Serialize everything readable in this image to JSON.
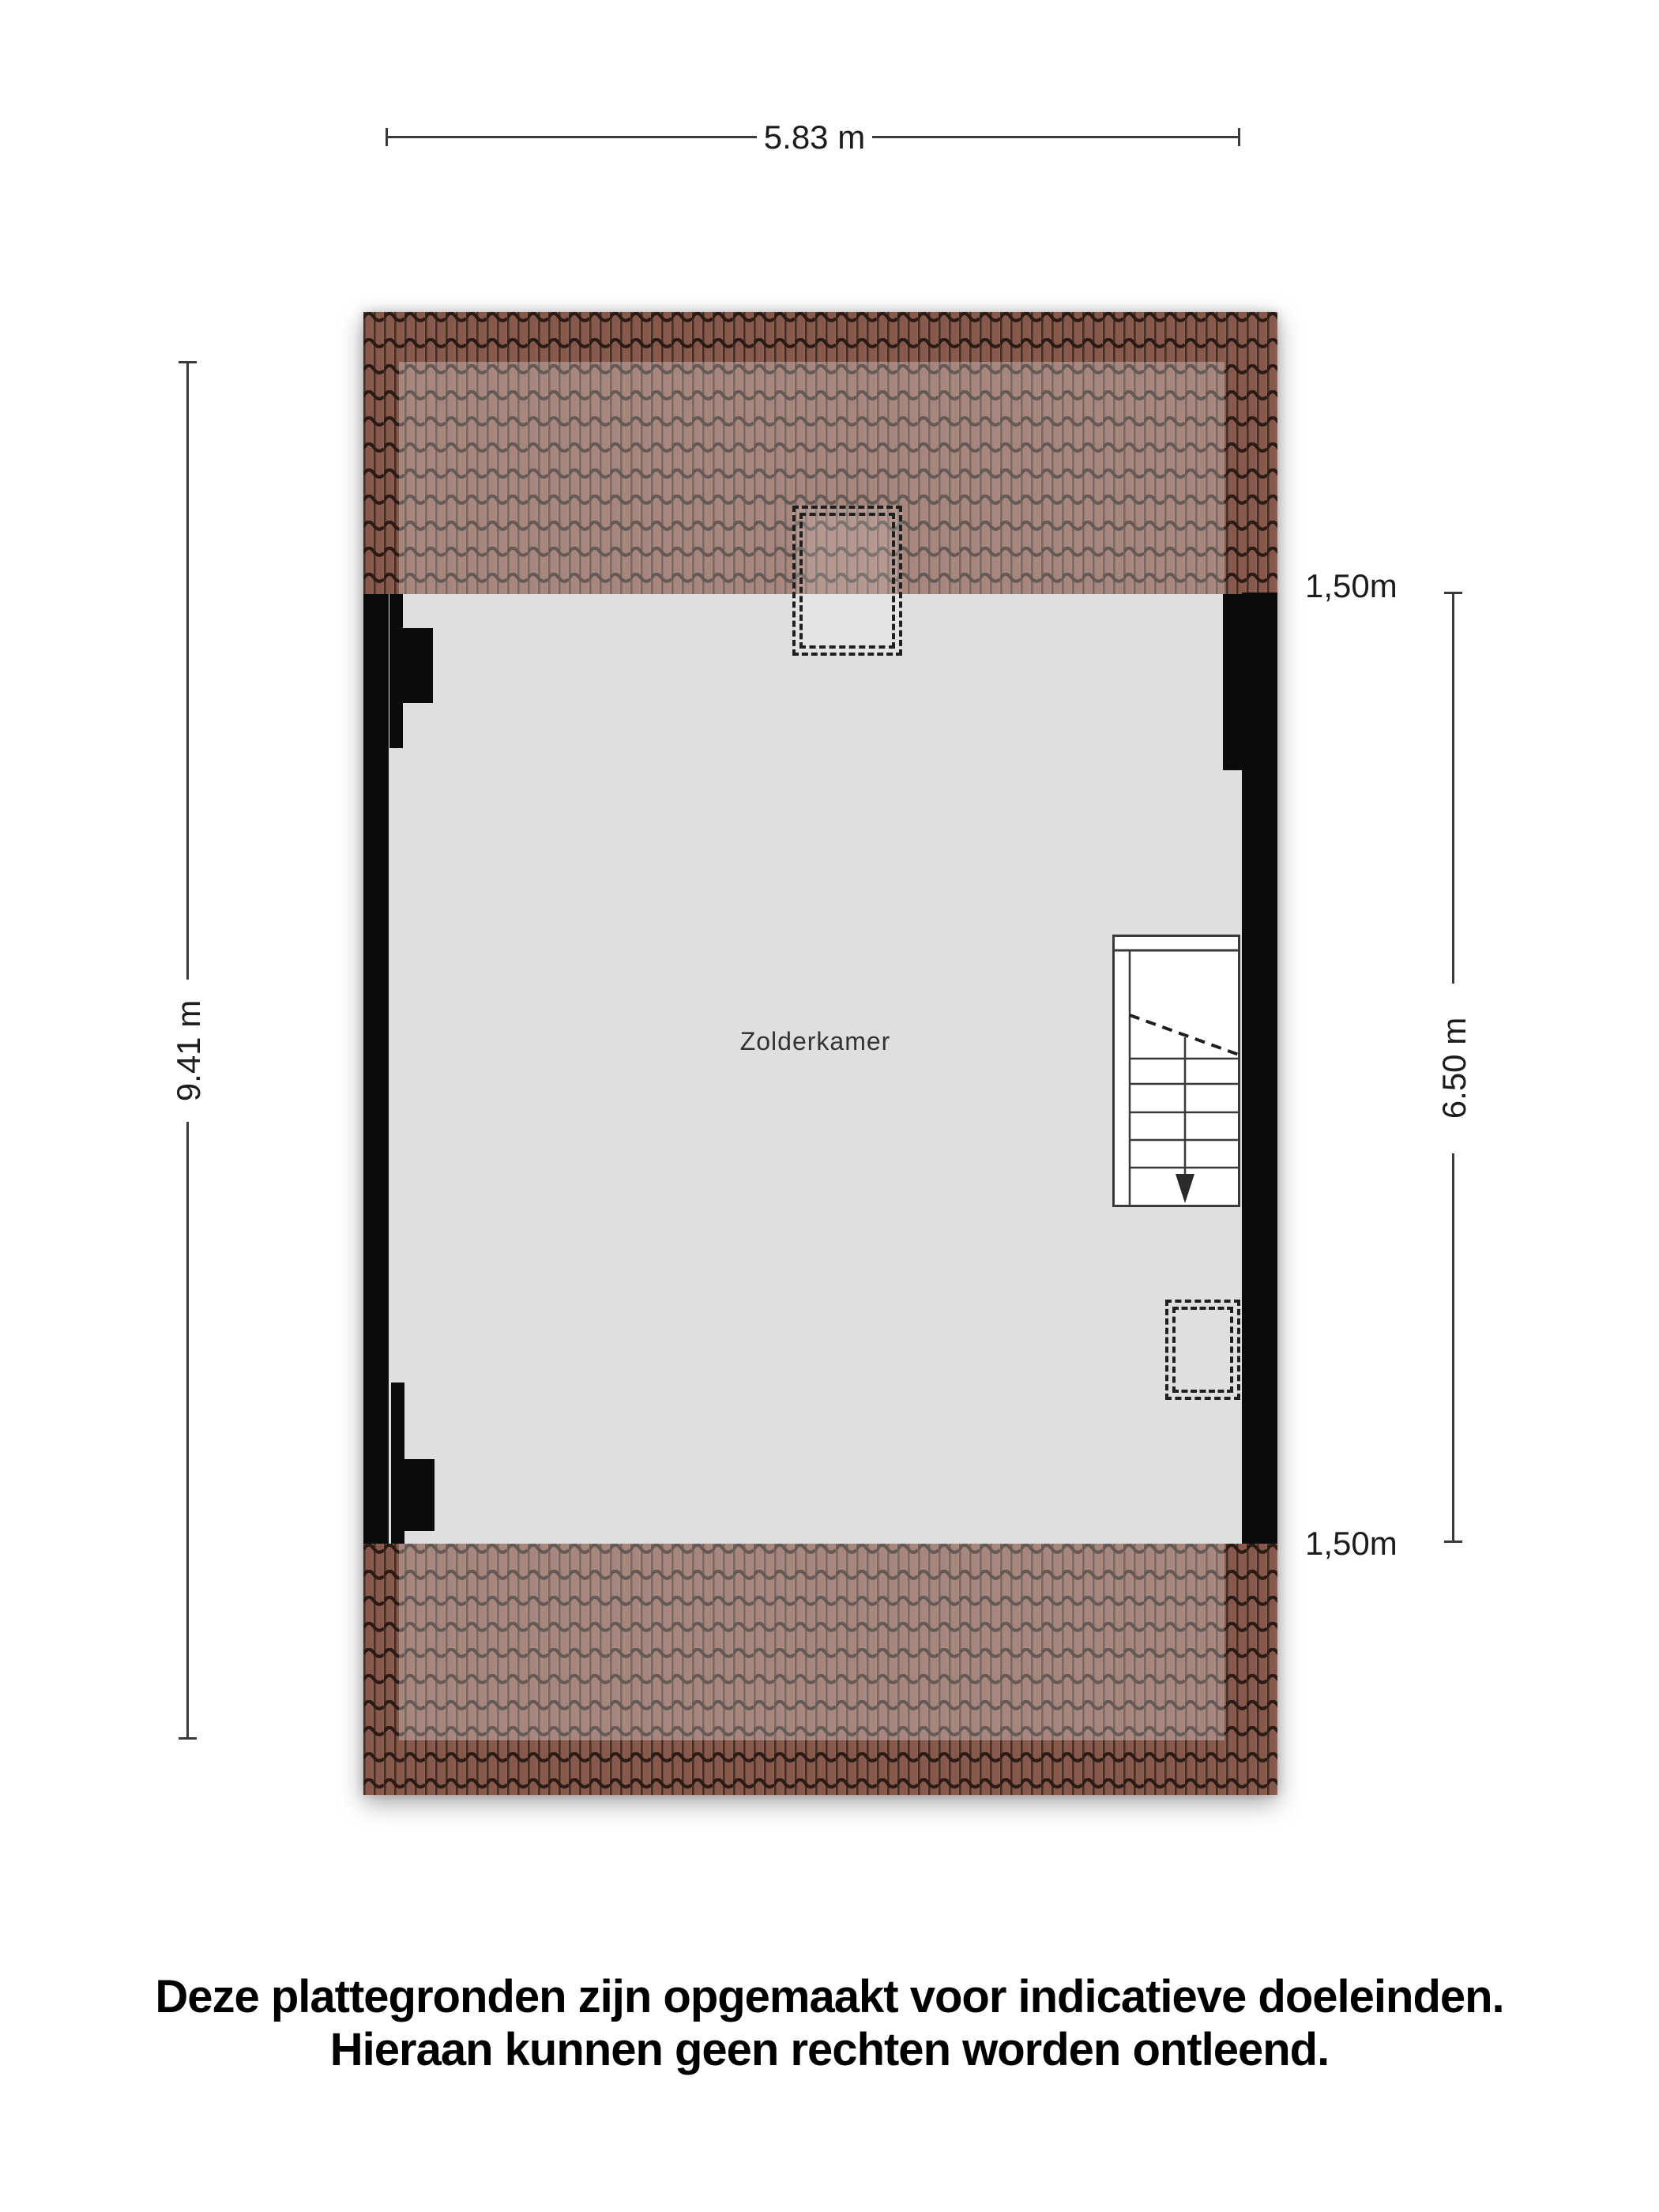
{
  "title": "Zolderkamer plattegrond",
  "floorplan": {
    "room_label": "Zolderkamer",
    "dim_top": "5.83 m",
    "dim_left": "9.41 m",
    "dim_right": "6.50 m",
    "dim_knee_top": "1,50m",
    "dim_knee_bottom": "1,50m",
    "colors": {
      "roof_tile_base": "#8d5e50",
      "roof_tile_joint": "#3a2620",
      "roof_tile_wave": "#2b1b15",
      "roof_inner_highlight": "rgba(255,255,255,0.28)",
      "floor": "#dfdfdf",
      "wall": "#0b0b0b",
      "dimension_line": "#3a3a3a",
      "text": "#1c1c1c"
    }
  },
  "disclaimer": {
    "line1": "Deze plattegronden zijn opgemaakt voor indicatieve doeleinden.",
    "line2": "Hieraan kunnen geen rechten worden ontleend."
  }
}
